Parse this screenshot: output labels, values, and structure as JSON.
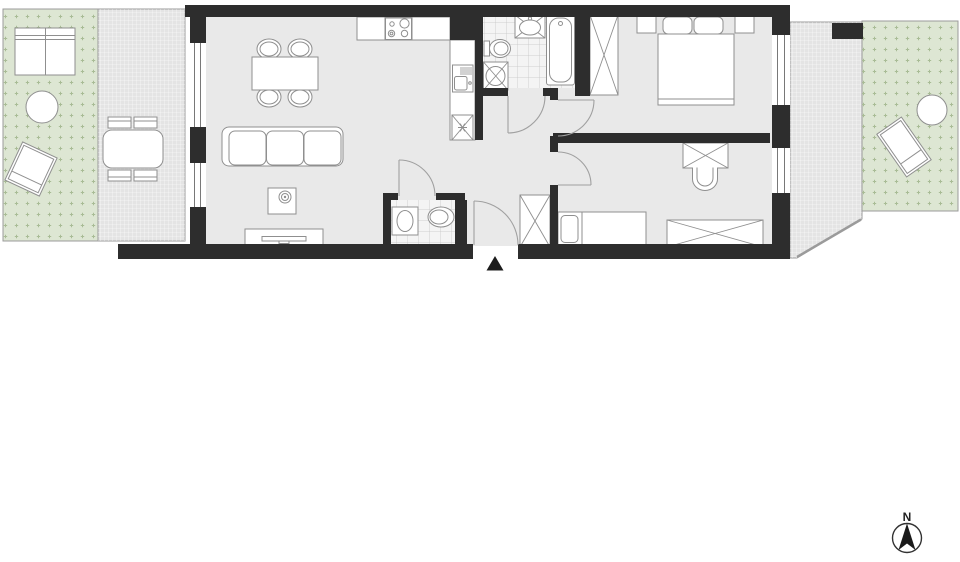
{
  "title": "apartment-floor-plan",
  "compass": {
    "label": "N",
    "direction": "north"
  },
  "colors": {
    "background": "#ffffff",
    "wall": "#2d2d2d",
    "floor": "#e9e9e9",
    "tile_floor": "#f4f4f4",
    "tile_line": "#c6c6c6",
    "garden": "#dde6d3",
    "garden_dots": "#a9bc96",
    "terrace": "#e4e4e4",
    "terrace_grid": "#ffffff",
    "furniture_outline": "#8f8f8f",
    "door_arc": "#a0a0a0",
    "outdoor_border": "#9b9b9b"
  },
  "outdoor": {
    "left_garden": {
      "surface": "grass-dotted",
      "furniture": [
        "outdoor-sofa",
        "round-table",
        "sun-lounger"
      ]
    },
    "left_terrace": {
      "surface": "paved-grid",
      "furniture": [
        "outdoor-dining-table",
        "chair",
        "chair",
        "chair",
        "chair"
      ]
    },
    "right_terrace": {
      "surface": "paved-grid",
      "furniture": []
    },
    "right_garden": {
      "surface": "grass-dotted",
      "furniture": [
        "sun-lounger",
        "round-table"
      ]
    }
  },
  "rooms": {
    "living_room_with_kitchen": {
      "windows": 2,
      "furniture": [
        "kitchen-counter",
        "cooktop",
        "kitchen-sink",
        "fridge",
        "dining-table",
        "chair",
        "chair",
        "chair",
        "chair",
        "sofa-three-seat",
        "coffee-table",
        "tv-bench"
      ]
    },
    "bathroom": {
      "furniture": [
        "washbasin",
        "toilet",
        "washing-machine",
        "bathtub"
      ]
    },
    "wc": {
      "furniture": [
        "washbasin",
        "toilet"
      ]
    },
    "hallway": {
      "furniture": [
        "wardrobe"
      ],
      "entrance_marker": "triangle"
    },
    "bedroom": {
      "windows": 1,
      "furniture": [
        "wardrobe",
        "double-bed",
        "nightstand",
        "nightstand"
      ]
    },
    "second_room": {
      "windows": 1,
      "furniture": [
        "single-bed",
        "desk",
        "chair",
        "wardrobe"
      ]
    }
  }
}
